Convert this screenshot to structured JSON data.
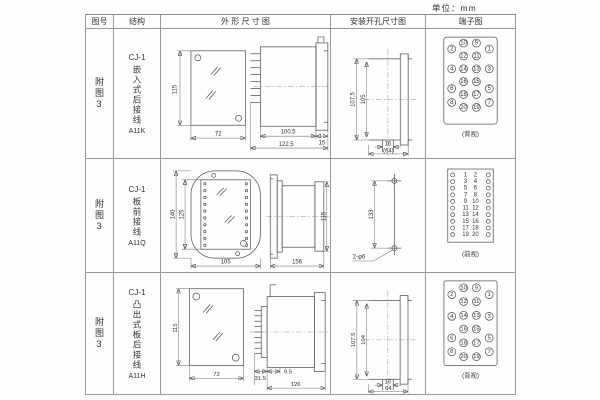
{
  "unit_label": "单位：mm",
  "table": {
    "headers": {
      "fig_no": "图号",
      "structure": "结构",
      "outline": "外 形 尺 寸 图",
      "install": "安装开孔尺寸图",
      "terminal": "端子图"
    }
  },
  "rows": [
    {
      "fig_no": "附图3",
      "model": "CJ-1",
      "mount_desc": "嵌入式后接线",
      "type_code": "A11K",
      "outline": {
        "front_height": "115",
        "front_width": "72",
        "body_length": "100.5",
        "total_length": "122.5",
        "flange_depth": "15"
      },
      "install": {
        "outer_height": "107.5",
        "inner_height": "105",
        "slot_width": "16",
        "span_width": "(64)"
      },
      "terminal": {
        "view_label": "(背视)",
        "outer_left": [
          "2",
          "4",
          "6",
          "8"
        ],
        "mid_left": [
          "10",
          "12",
          "14",
          "16",
          "18",
          "20"
        ],
        "mid_right": [
          "9",
          "11",
          "13",
          "15",
          "17",
          "19"
        ],
        "outer_right": [
          "1",
          "3",
          "5",
          "7"
        ]
      }
    },
    {
      "fig_no": "附图3",
      "model": "CJ-1",
      "mount_desc": "板前接线",
      "type_code": "A11Q",
      "outline": {
        "front_outer_height": "140",
        "front_inner_height": "125",
        "front_width": "105",
        "side_length": "156",
        "side_height": "115"
      },
      "install": {
        "hole_pitch": "133",
        "hole_spec": "2-φ6"
      },
      "terminal": {
        "view_label": "(前视)",
        "pairs": [
          [
            "1",
            "2"
          ],
          [
            "3",
            "4"
          ],
          [
            "5",
            "6"
          ],
          [
            "7",
            "8"
          ],
          [
            "9",
            "10"
          ],
          [
            "11",
            "12"
          ],
          [
            "13",
            "14"
          ],
          [
            "15",
            "16"
          ],
          [
            "17",
            "18"
          ],
          [
            "19",
            "20"
          ]
        ]
      }
    },
    {
      "fig_no": "附图3",
      "model": "CJ-1",
      "mount_desc": "凸出式板后接线",
      "type_code": "A11H",
      "outline": {
        "front_height": "115",
        "front_width": "72",
        "pin_length": "31.5",
        "offset": "9.5",
        "total_length": "126"
      },
      "install": {
        "outer_height": "107.5",
        "inner_height": "104",
        "slot_width": "16",
        "span_width": "64"
      },
      "terminal": {
        "view_label": "(背视)",
        "outer_left": [
          "2",
          "4",
          "6",
          "8"
        ],
        "mid_left": [
          "10",
          "12",
          "14",
          "16",
          "18",
          "20"
        ],
        "mid_right": [
          "9",
          "11",
          "13",
          "15",
          "17",
          "19"
        ],
        "outer_right": [
          "1",
          "3",
          "5",
          "7"
        ]
      }
    }
  ]
}
